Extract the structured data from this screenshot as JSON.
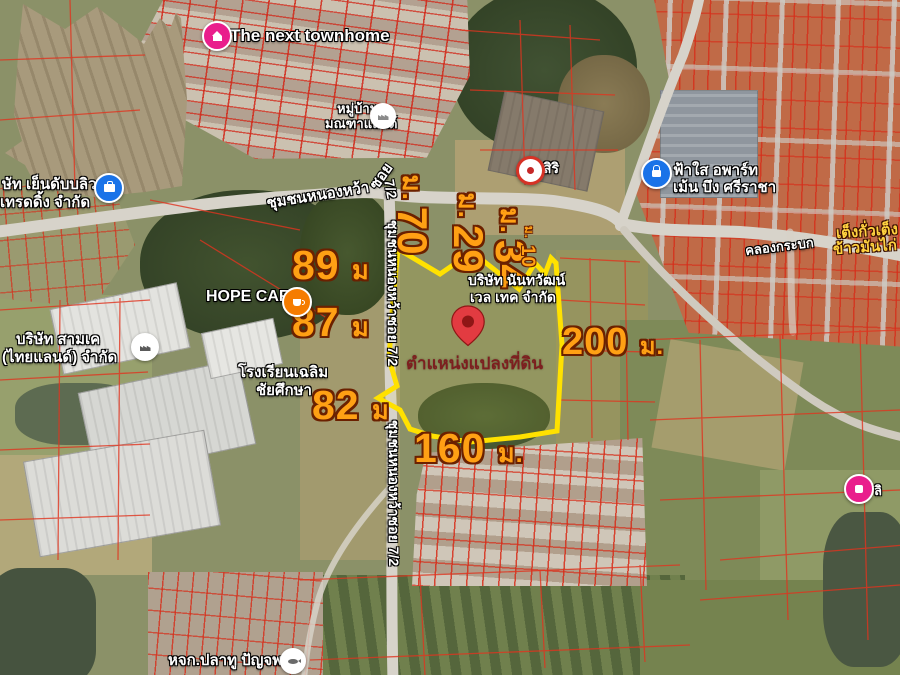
{
  "map": {
    "pin_caption": "ตำแหน่งแปลงที่ดิน",
    "dimensions": [
      {
        "value": "89",
        "unit": "ม"
      },
      {
        "value": "87",
        "unit": "ม"
      },
      {
        "value": "82",
        "unit": "ม"
      },
      {
        "value": "160",
        "unit": "ม."
      },
      {
        "value": "200",
        "unit": "ม."
      },
      {
        "value": "70",
        "unit": "ม."
      },
      {
        "value": "29",
        "unit": "ม."
      },
      {
        "value": "34",
        "unit": "ม."
      },
      {
        "value": "10",
        "unit": "ม."
      }
    ],
    "roads": {
      "main": "ชุมชนหนองหว้า",
      "soi": "ซอย",
      "soi_no": "7/2",
      "vertical": "ชุมชนหนองหว้าซอย 7/2",
      "canal": "คลองกระบก"
    },
    "places": {
      "townhome": "The next townhome",
      "village_1": "หมู่บ้าน",
      "village_2": "มณฑาแลนด์",
      "hope_cafe": "HOPE CAFE",
      "yen_w_1": "ษัท เย็นดับบลิว",
      "yen_w_2": "เทรดดิ้ง จำกัด",
      "siri": "สิริ",
      "fasai_1": "ฟ้าใส อพาร์ท",
      "fasai_2": "เม้น บึง ศรีราชา",
      "nantawan_1": "บริษัท นันทวัฒน์",
      "nantawan_2": "เวล เทค จำกัด",
      "samk_1": "บริษัท สามเค",
      "samk_2": "(ไทยแลนด์) จำกัด",
      "school_1": "โรงเรียนเฉลิม",
      "school_2": "ชัยศึกษา",
      "teng_1": "เต็งกั่วเต็ง",
      "teng_2": "ข้าวมันไก่",
      "plathu": "หจก.ปลาทู ปัญจพล",
      "li": "ลิ"
    },
    "colors": {
      "plot_outline": "#ffe100",
      "dimension_text": "#ffa014",
      "pin": "#e23b41",
      "poi_blue": "#1a73e8",
      "poi_pink": "#e91e8c",
      "poi_orange": "#f57c00"
    }
  }
}
